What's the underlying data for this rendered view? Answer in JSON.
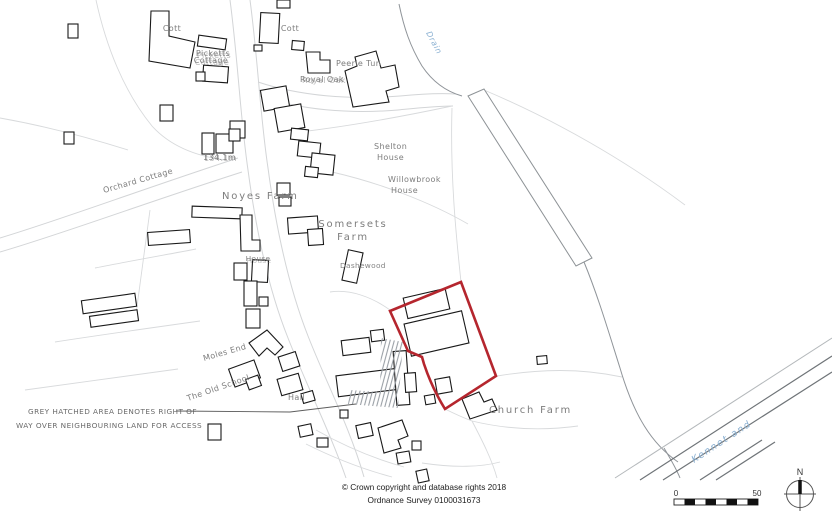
{
  "colors": {
    "boundary_red": "#b5262e",
    "water_label_blue": "#8ab0d2",
    "map_label_grey": "#7d7d7d"
  },
  "map_labels": {
    "cott_west": "Cott",
    "cott_east": "Cott",
    "picketts_line1": "Picketts",
    "picketts_line2": "Cottage",
    "peerle_tun": "Peerle Tun",
    "royal_oak": "Royal Oak",
    "spot_height": "134.1m",
    "orchard_cottage": "Orchard Cottage",
    "noyes_farm": "Noyes Farm",
    "shelton_line1": "Shelton",
    "shelton_line2": "House",
    "willowbrook_line1": "Willowbrook",
    "willowbrook_line2": "House",
    "somersets_line1": "Somersets",
    "somersets_line2": "Farm",
    "house": "House",
    "dashewood": "Dashewood",
    "moles_end": "Moles End",
    "old_school": "The Old School",
    "hall": "Hall",
    "church_farm": "Church Farm",
    "drain": "Drain",
    "canal": "Kennet and"
  },
  "annotation": {
    "line1": "GREY HATCHED AREA DENOTES RIGHT OF",
    "line2": "WAY OVER NEIGHBOURING LAND FOR ACCESS"
  },
  "copyright": {
    "line1": "© Crown copyright and database rights 2018",
    "line2": "Ordnance Survey 0100031673"
  },
  "scale_bar": {
    "start": "0",
    "end": "50"
  },
  "compass": {
    "north": "N"
  }
}
